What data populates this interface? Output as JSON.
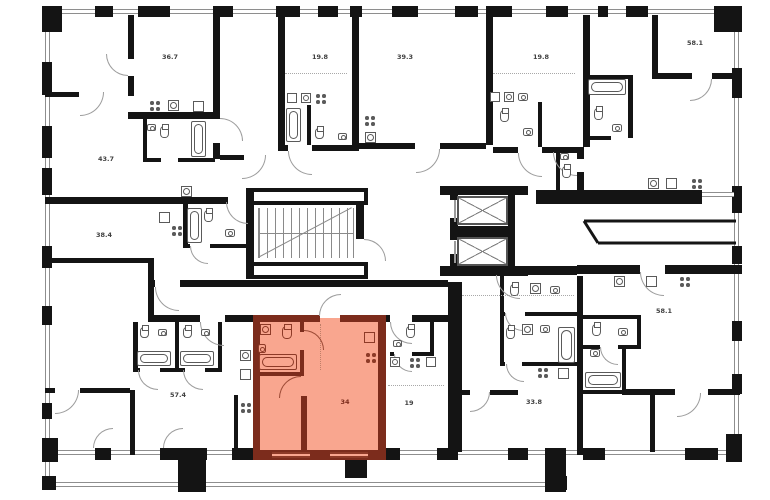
{
  "plan_type": "residential-floor-plan",
  "colors": {
    "wall": "#141414",
    "highlight_fill": "#f9a68f",
    "highlight_wall": "#7c2c1c",
    "fixture_stroke": "#5a5a5a",
    "window_stroke": "#8e8e8e"
  },
  "units": [
    {
      "name": "unit-top-left",
      "area": "36.7"
    },
    {
      "name": "unit-top-1",
      "area": "19.8"
    },
    {
      "name": "unit-top-2",
      "area": "39.3"
    },
    {
      "name": "unit-top-3",
      "area": "19.8"
    },
    {
      "name": "unit-top-right",
      "area": "58.1"
    },
    {
      "name": "unit-left-1",
      "area": "43.7"
    },
    {
      "name": "unit-left-2",
      "area": "38.4"
    },
    {
      "name": "unit-right-middle",
      "area": "58.1"
    },
    {
      "name": "unit-bottom-left",
      "area": "57.4"
    },
    {
      "name": "unit-highlighted",
      "area": "34",
      "highlighted": true
    },
    {
      "name": "unit-bottom-middle",
      "area": "19"
    },
    {
      "name": "unit-bottom-right",
      "area": "33.8"
    }
  ],
  "core": {
    "stairs": "stairwell",
    "elevators": [
      "elevator-1",
      "elevator-2"
    ]
  }
}
